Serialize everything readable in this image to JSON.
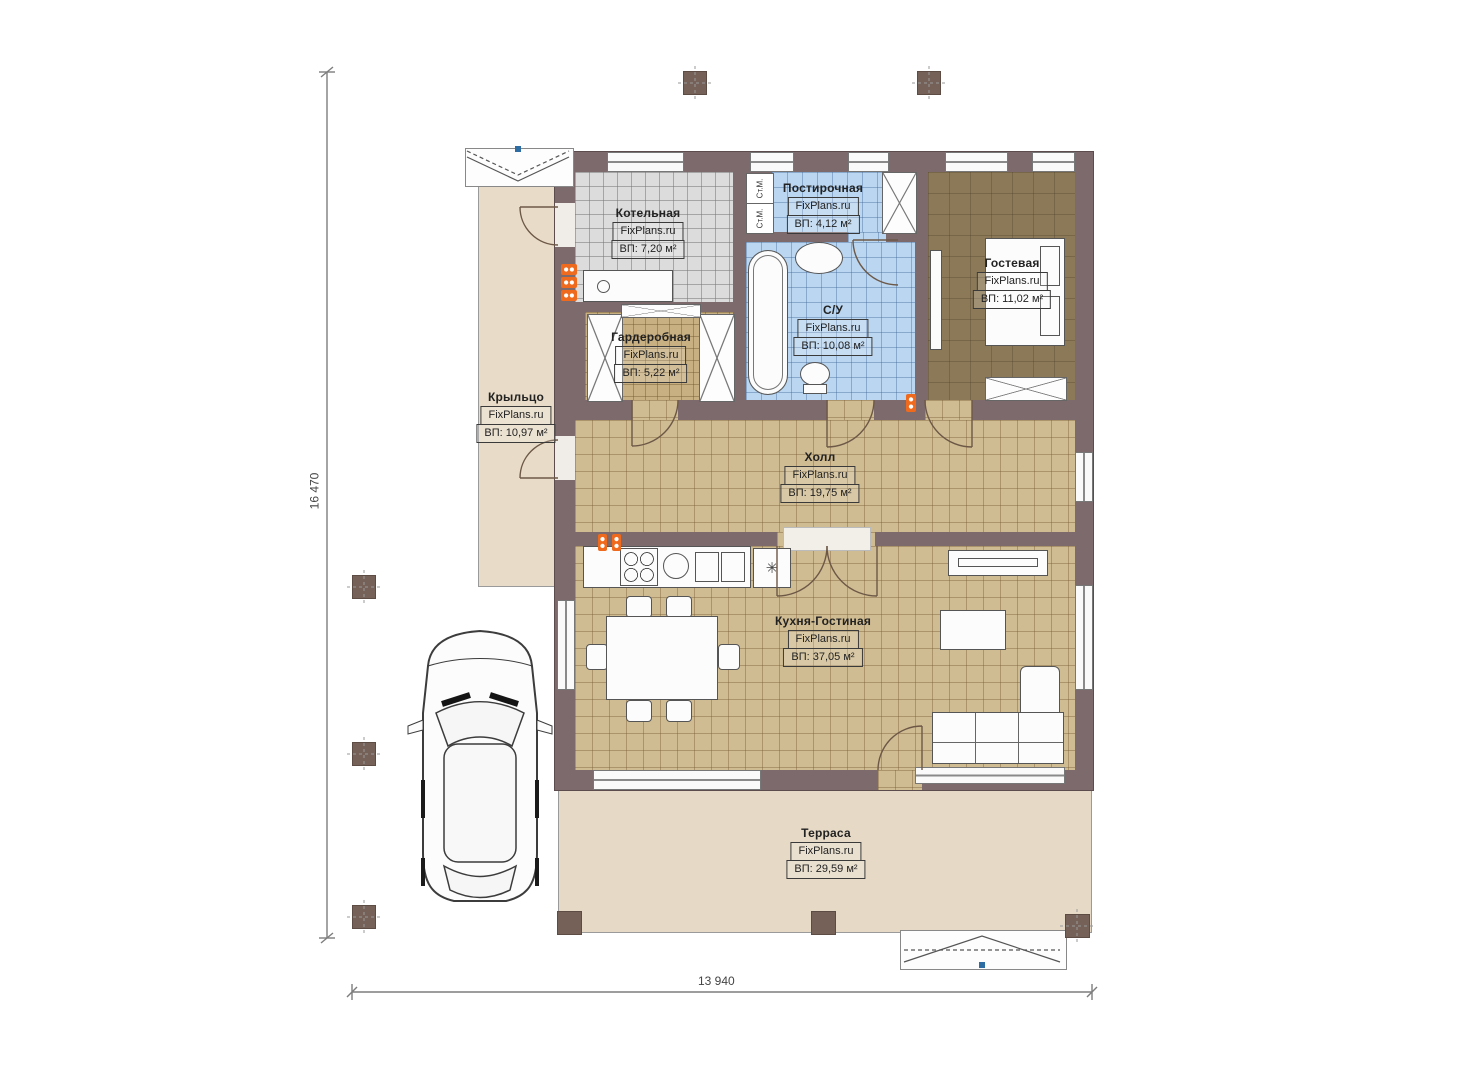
{
  "dimensions": {
    "left": "16 470",
    "bottom": "13 940"
  },
  "rooms": [
    {
      "id": "kotelnaya",
      "name": "Котельная",
      "brand": "FixPlans.ru",
      "area": "ВП: 7,20 м²"
    },
    {
      "id": "postirochnaya",
      "name": "Постирочная",
      "brand": "FixPlans.ru",
      "area": "ВП: 4,12 м²"
    },
    {
      "id": "su",
      "name": "С/У",
      "brand": "FixPlans.ru",
      "area": "ВП: 10,08 м²"
    },
    {
      "id": "gostevaya",
      "name": "Гостевая",
      "brand": "FixPlans.ru",
      "area": "ВП: 11,02 м²"
    },
    {
      "id": "garderobnaya",
      "name": "Гардеробная",
      "brand": "FixPlans.ru",
      "area": "ВП: 5,22 м²"
    },
    {
      "id": "kryltso",
      "name": "Крыльцо",
      "brand": "FixPlans.ru",
      "area": "ВП: 10,97 м²"
    },
    {
      "id": "holl",
      "name": "Холл",
      "brand": "FixPlans.ru",
      "area": "ВП: 19,75 м²"
    },
    {
      "id": "kuhnya",
      "name": "Кухня-Гостиная",
      "brand": "FixPlans.ru",
      "area": "ВП: 37,05 м²"
    },
    {
      "id": "terrasa",
      "name": "Терраса",
      "brand": "FixPlans.ru",
      "area": "ВП: 29,59 м²"
    }
  ],
  "labels": {
    "washer1": "Ст.М.",
    "washer2": "Ст.М.",
    "fridge_glyph": "✳"
  },
  "colors": {
    "wall": "#7c6a6c",
    "floor_tan": "#d0bc92",
    "floor_blue": "#bad6f0",
    "floor_gray": "#dcdcdc",
    "floor_guest": "#8b7957",
    "porch": "#e8dcc8",
    "terrace": "#e6dac6",
    "radiator_orange": "#f06a1d",
    "dimension_gray": "#7d7d7d"
  }
}
